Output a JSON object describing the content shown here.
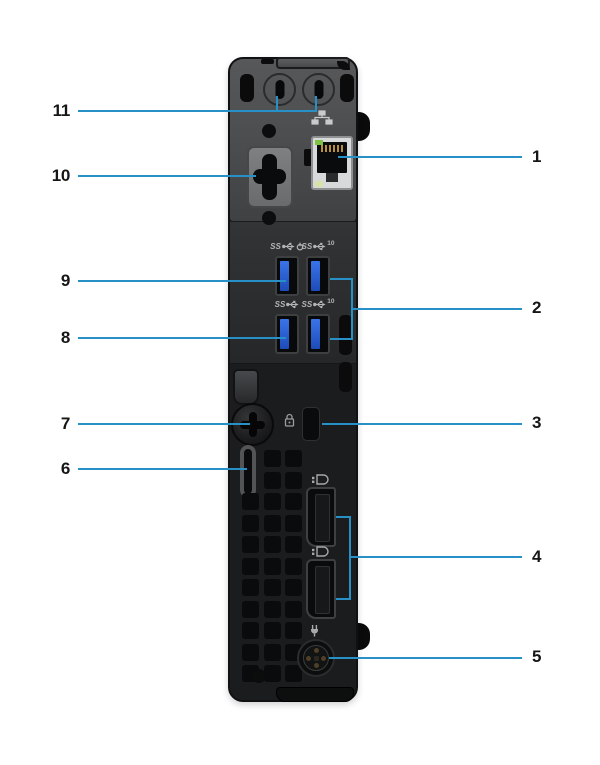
{
  "page": {
    "background": "#ffffff"
  },
  "callout": {
    "line_color": "#2790c7",
    "numbers": {
      "n1": "1",
      "n2": "2",
      "n3": "3",
      "n4": "4",
      "n5": "5",
      "n6": "6",
      "n7": "7",
      "n8": "8",
      "n9": "9",
      "n10": "10",
      "n11": "11"
    }
  },
  "port_icons": {
    "usb_ss_text": "SS",
    "usb_gen2_speed": "10",
    "icon_names": [
      "network-icon",
      "usb-smartpower-icon",
      "usb-10gbps-icon",
      "usb-ss-icon",
      "kensington-lock-icon",
      "displayport-icon",
      "power-plug-icon"
    ]
  },
  "device": {
    "usb_accent_blue": "#2f62c9",
    "chassis_dark": "#1b1c1d",
    "chassis_light": "#565859"
  }
}
